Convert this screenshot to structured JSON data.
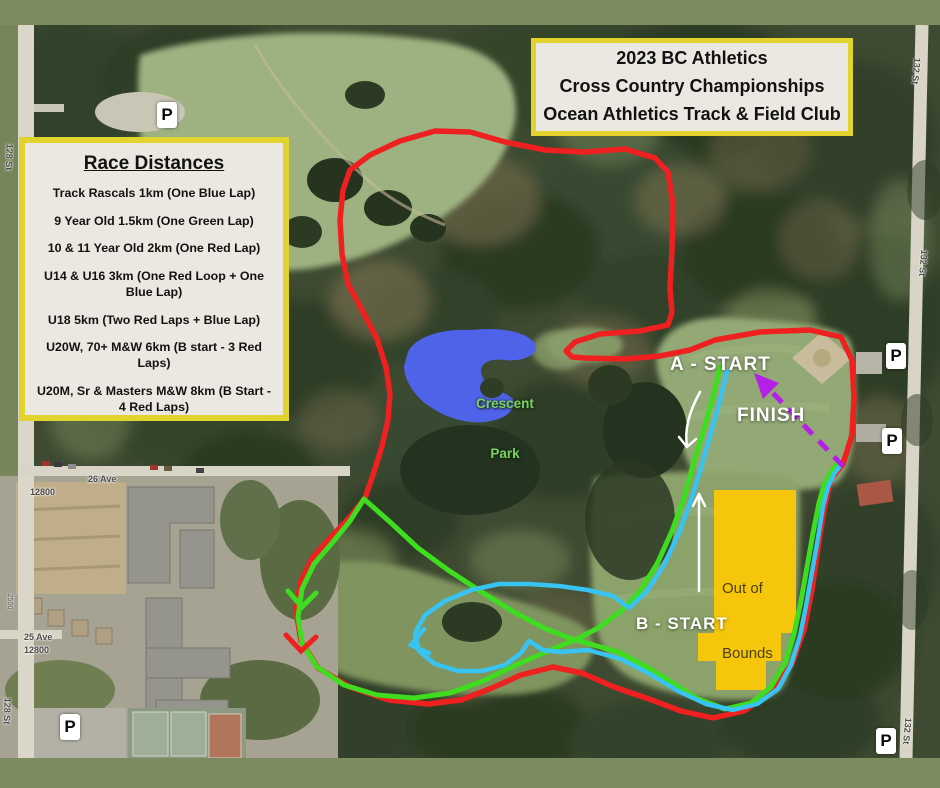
{
  "title_box": {
    "lines": [
      "2023 BC Athletics",
      "Cross Country Championships",
      "Ocean Athletics Track & Field Club"
    ]
  },
  "race_box": {
    "title": "Race Distances",
    "items": [
      "Track Rascals  1km (One Blue Lap)",
      "9 Year Old 1.5km (One Green Lap)",
      "10 & 11 Year Old 2km (One Red Lap)",
      "U14 & U16 3km (One Red Loop + One Blue Lap)",
      "U18 5km (Two Red Laps + Blue Lap)",
      "U20W, 70+ M&W 6km (B start - 3 Red Laps)",
      "U20M, Sr & Masters M&W 8km (B Start - 4 Red Laps)"
    ]
  },
  "map_labels": {
    "a_start": "A - START",
    "finish": "FINISH",
    "b_start": "B - START",
    "out_of_bounds_line1": "Out of",
    "out_of_bounds_line2": "Bounds",
    "park_line1": "Crescent",
    "park_line2": "Park",
    "parking": "P",
    "street_128": "128 St",
    "street_132": "132 St",
    "ave_26": "26 Ave",
    "ave_25": "25 Ave",
    "block_12800": "12800",
    "house_2500": "2500"
  },
  "course_colors": {
    "red_lap": "#ee2020",
    "green_lap": "#3fdd20",
    "blue_lap": "#38c4f2",
    "finish_arrow": "#b520e8",
    "out_of_bounds_fill": "#f6c60c"
  }
}
